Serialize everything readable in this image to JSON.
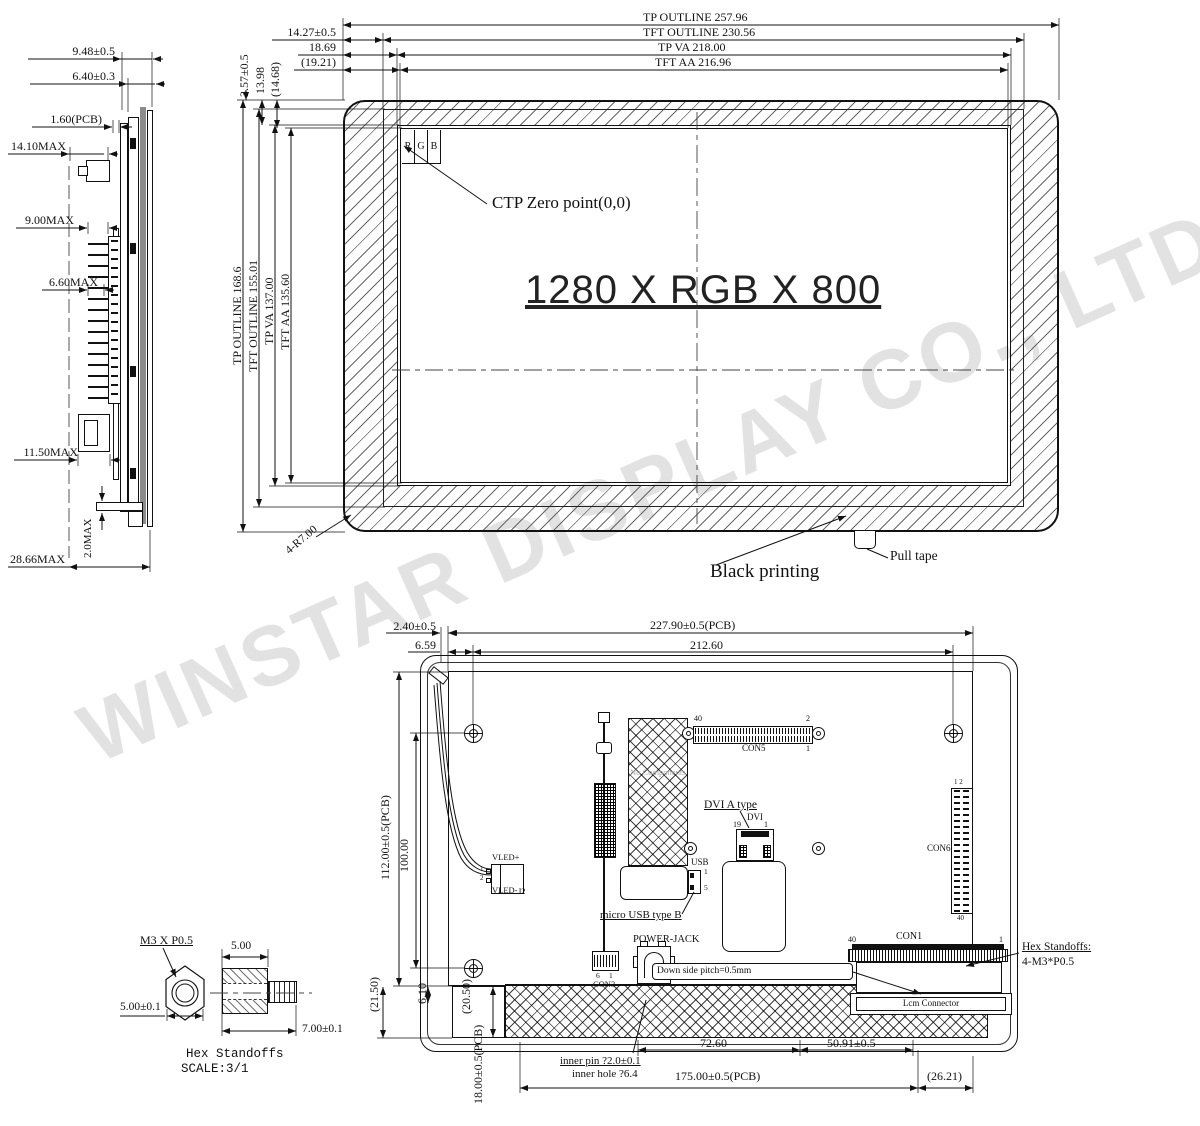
{
  "watermark": {
    "text": "WINSTAR DISPLAY CO., LTD."
  },
  "side": {
    "d948": "9.48±0.5",
    "d640": "6.40±0.3",
    "d160": "1.60(PCB)",
    "d1410": "14.10MAX",
    "d900": "9.00MAX",
    "d660": "6.60MAX",
    "d1150": "11.50MAX",
    "d20": "2.0MAX",
    "d2866": "28.66MAX"
  },
  "front": {
    "tp_w": "TP OUTLINE 257.96",
    "tft_w": "TFT OUTLINE 230.56",
    "va_w": "TP VA 218.00",
    "aa_w": "TFT AA 216.96",
    "d1427": "14.27±0.5",
    "d1869": "18.69",
    "d1921": "(19.21)",
    "d357": "3.57±0.5",
    "d1398": "13.98",
    "d1468": "(14.68)",
    "tp_h": "TP OUTLINE 168.6",
    "tft_h": "TFT OUTLINE 155.01",
    "va_h": "TP VA 137.00",
    "aa_h": "TFT AA 135.60",
    "r": "R",
    "g": "G",
    "b": "B",
    "ctp_zero": "CTP Zero point(0,0)",
    "resolution": "1280 X RGB X 800",
    "radius": "4-R7.00",
    "black_printing": "Black printing",
    "pull_tape": "Pull tape"
  },
  "pcb": {
    "d240": "2.40±0.5",
    "d22790": "227.90±0.5(PCB)",
    "d659": "6.59",
    "d21260": "212.60",
    "d11200": "112.00±0.5(PCB)",
    "d10000": "100.00",
    "d2150": "(21.50)",
    "d610": "6.10",
    "d2050": "(20.50)",
    "d1800": "18.00±0.5(PCB)",
    "d7260": "72.60",
    "d5091": "50.91±0.5",
    "d17500": "175.00±0.5(PCB)",
    "d2621": "(26.21)",
    "inner_pin": "inner pin ?2.0±0.1",
    "inner_hole": "inner hole ?6.4",
    "no_components": "No Components",
    "con5": "CON5",
    "con5_p40": "40",
    "con5_p2": "2",
    "con5_p1": "1",
    "con6": "CON6",
    "con6_p12": "1 2",
    "con6_p40": "40",
    "con1": "CON1",
    "con1_p40": "40",
    "con1_p1": "1",
    "con3": "CON3",
    "con3_p6": "6",
    "con3_p1": "1",
    "vled_plus": "VLED+",
    "vled_minus": "VLED-",
    "j2": "J2",
    "vled_p1": "1",
    "vled_p2": "2",
    "dvi_type": "DVI A type",
    "dvi": "DVI",
    "dvi_p19": "19",
    "dvi_p1": "1",
    "usb": "USB",
    "usb_p1": "1",
    "usb_p5": "5",
    "micro_usb": "micro USB  type B",
    "power_jack": "POWER-JACK",
    "pitch": "Down side pitch=0.5mm",
    "lcm": "Lcm Connector",
    "hex1": "Hex Standoffs:",
    "hex2": "4-M3*P0.5"
  },
  "standoff": {
    "thread": "M3 X P0.5",
    "d500t": "5.00",
    "d500": "5.00±0.1",
    "d700": "7.00±0.1",
    "title": "Hex Standoffs",
    "scale": "SCALE:3/1"
  }
}
